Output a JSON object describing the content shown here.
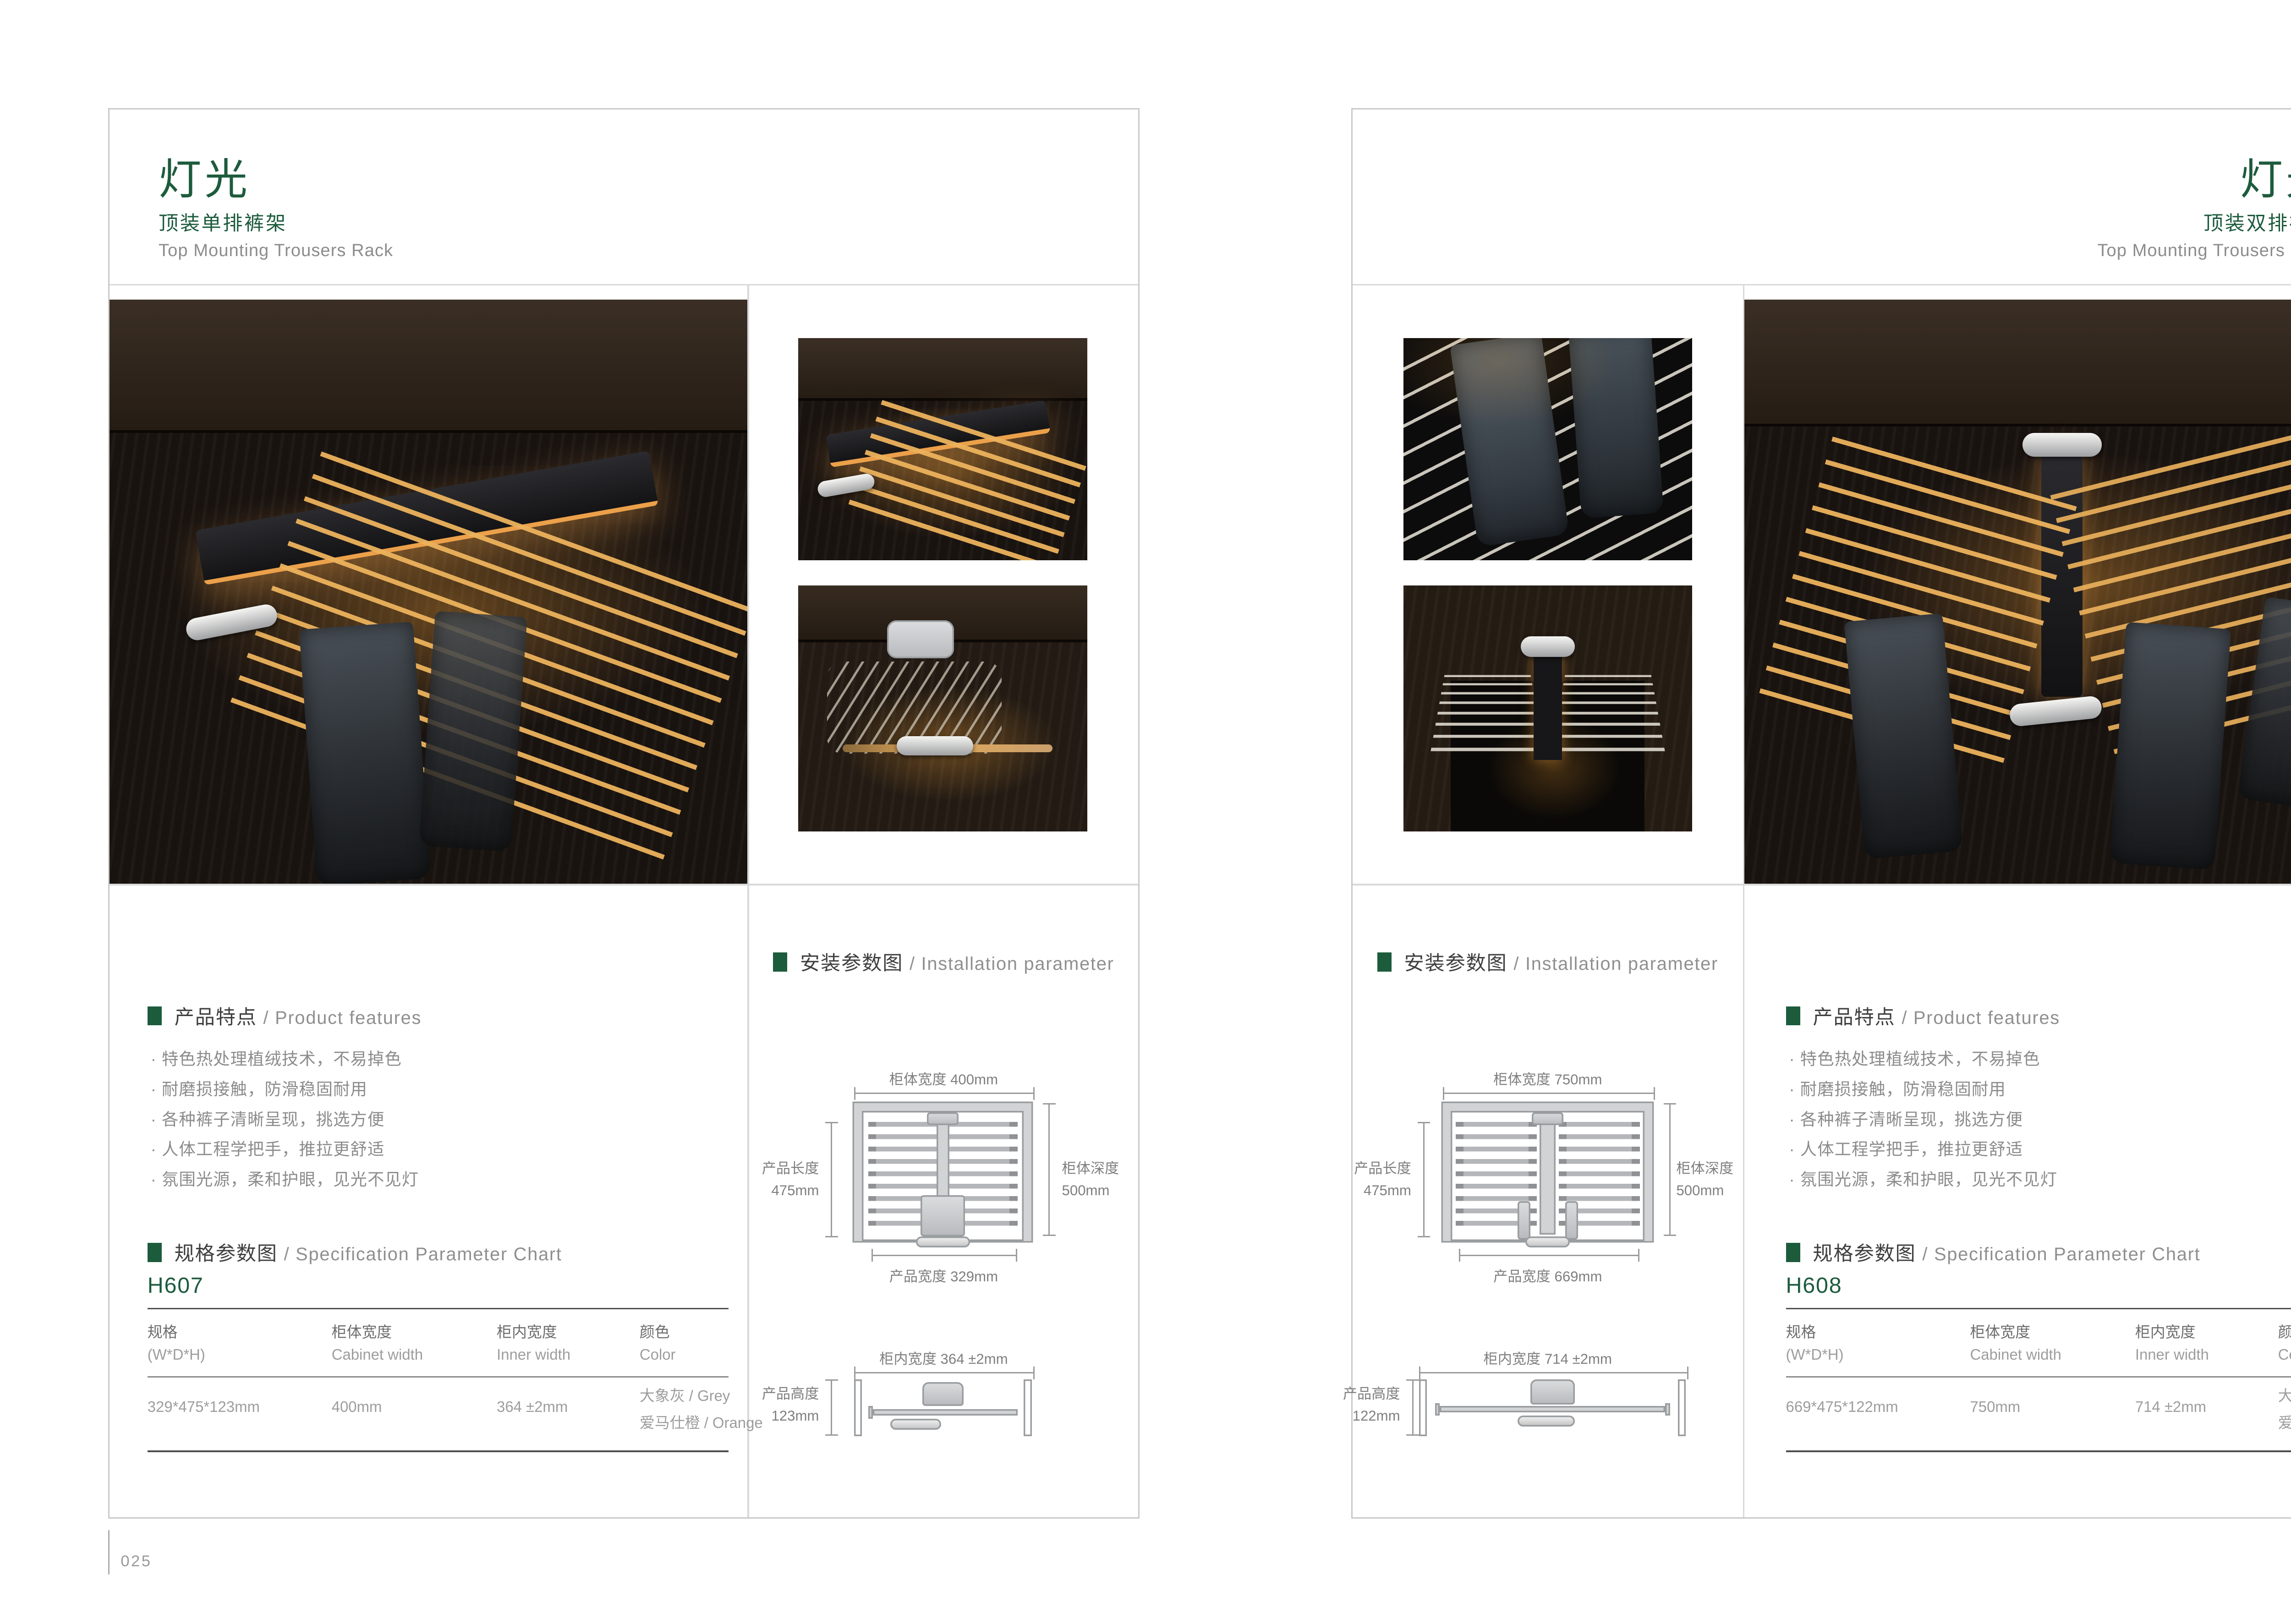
{
  "colors": {
    "accent_green": "#1d5b3d",
    "heading_dark": "#3f3f3f",
    "body_gray": "#8c8c8c"
  },
  "l": {
    "page_number": "025",
    "header": {
      "title": "灯光",
      "subtitle": "顶装单排裤架",
      "subtitle_en": "Top Mounting Trousers Rack"
    },
    "features": {
      "title": "产品特点",
      "title_en": "/ Product features",
      "bullet": "·",
      "items": [
        "特色热处理植绒技术，不易掉色",
        "耐磨损接触，防滑稳固耐用",
        "各种裤子清晰呈现，挑选方便",
        "人体工程学把手，推拉更舒适",
        "氛围光源，柔和护眼，见光不见灯"
      ]
    },
    "spec": {
      "title": "规格参数图",
      "title_en": "/ Specification Parameter Chart",
      "model": "H607",
      "cols": [
        {
          "cn": "规格",
          "en": "(W*D*H)"
        },
        {
          "cn": "柜体宽度",
          "en": "Cabinet width"
        },
        {
          "cn": "柜内宽度",
          "en": "Inner width"
        },
        {
          "cn": "颜色",
          "en": "Color"
        }
      ],
      "row": {
        "size": "329*475*123mm",
        "cabinet": "400mm",
        "inner": "364 ±2mm",
        "color1": "大象灰 / Grey",
        "color2": "爱马仕橙 / Orange"
      }
    },
    "install": {
      "title": "安装参数图",
      "title_en": "/ Installation parameter",
      "top": {
        "w": "柜体宽度 400mm",
        "left1": "产品长度",
        "left2": "475mm",
        "right1": "柜体深度",
        "right2": "500mm",
        "bottom": "产品宽度 329mm"
      },
      "front": {
        "w": "柜内宽度 364 ±2mm",
        "left1": "产品高度",
        "left2": "123mm"
      }
    }
  },
  "r": {
    "page_number": "026",
    "header": {
      "title": "灯光",
      "subtitle": "顶装双排裤架",
      "subtitle_en": "Top Mounting Trousers Rack"
    },
    "features": {
      "title": "产品特点",
      "title_en": "/ Product features",
      "bullet": "·",
      "items": [
        "特色热处理植绒技术，不易掉色",
        "耐磨损接触，防滑稳固耐用",
        "各种裤子清晰呈现，挑选方便",
        "人体工程学把手，推拉更舒适",
        "氛围光源，柔和护眼，见光不见灯"
      ]
    },
    "spec": {
      "title": "规格参数图",
      "title_en": "/ Specification Parameter Chart",
      "model": "H608",
      "cols": [
        {
          "cn": "规格",
          "en": "(W*D*H)"
        },
        {
          "cn": "柜体宽度",
          "en": "Cabinet width"
        },
        {
          "cn": "柜内宽度",
          "en": "Inner width"
        },
        {
          "cn": "颜色",
          "en": "Color"
        }
      ],
      "row": {
        "size": "669*475*122mm",
        "cabinet": "750mm",
        "inner": "714 ±2mm",
        "color1": "大象灰 / Grey",
        "color2": "爱马仕橙 / Orange"
      }
    },
    "install": {
      "title": "安装参数图",
      "title_en": "/ Installation parameter",
      "top": {
        "w": "柜体宽度 750mm",
        "left1": "产品长度",
        "left2": "475mm",
        "right1": "柜体深度",
        "right2": "500mm",
        "bottom": "产品宽度 669mm"
      },
      "front": {
        "w": "柜内宽度 714 ±2mm",
        "left1": "产品高度",
        "left2": "122mm"
      }
    }
  }
}
